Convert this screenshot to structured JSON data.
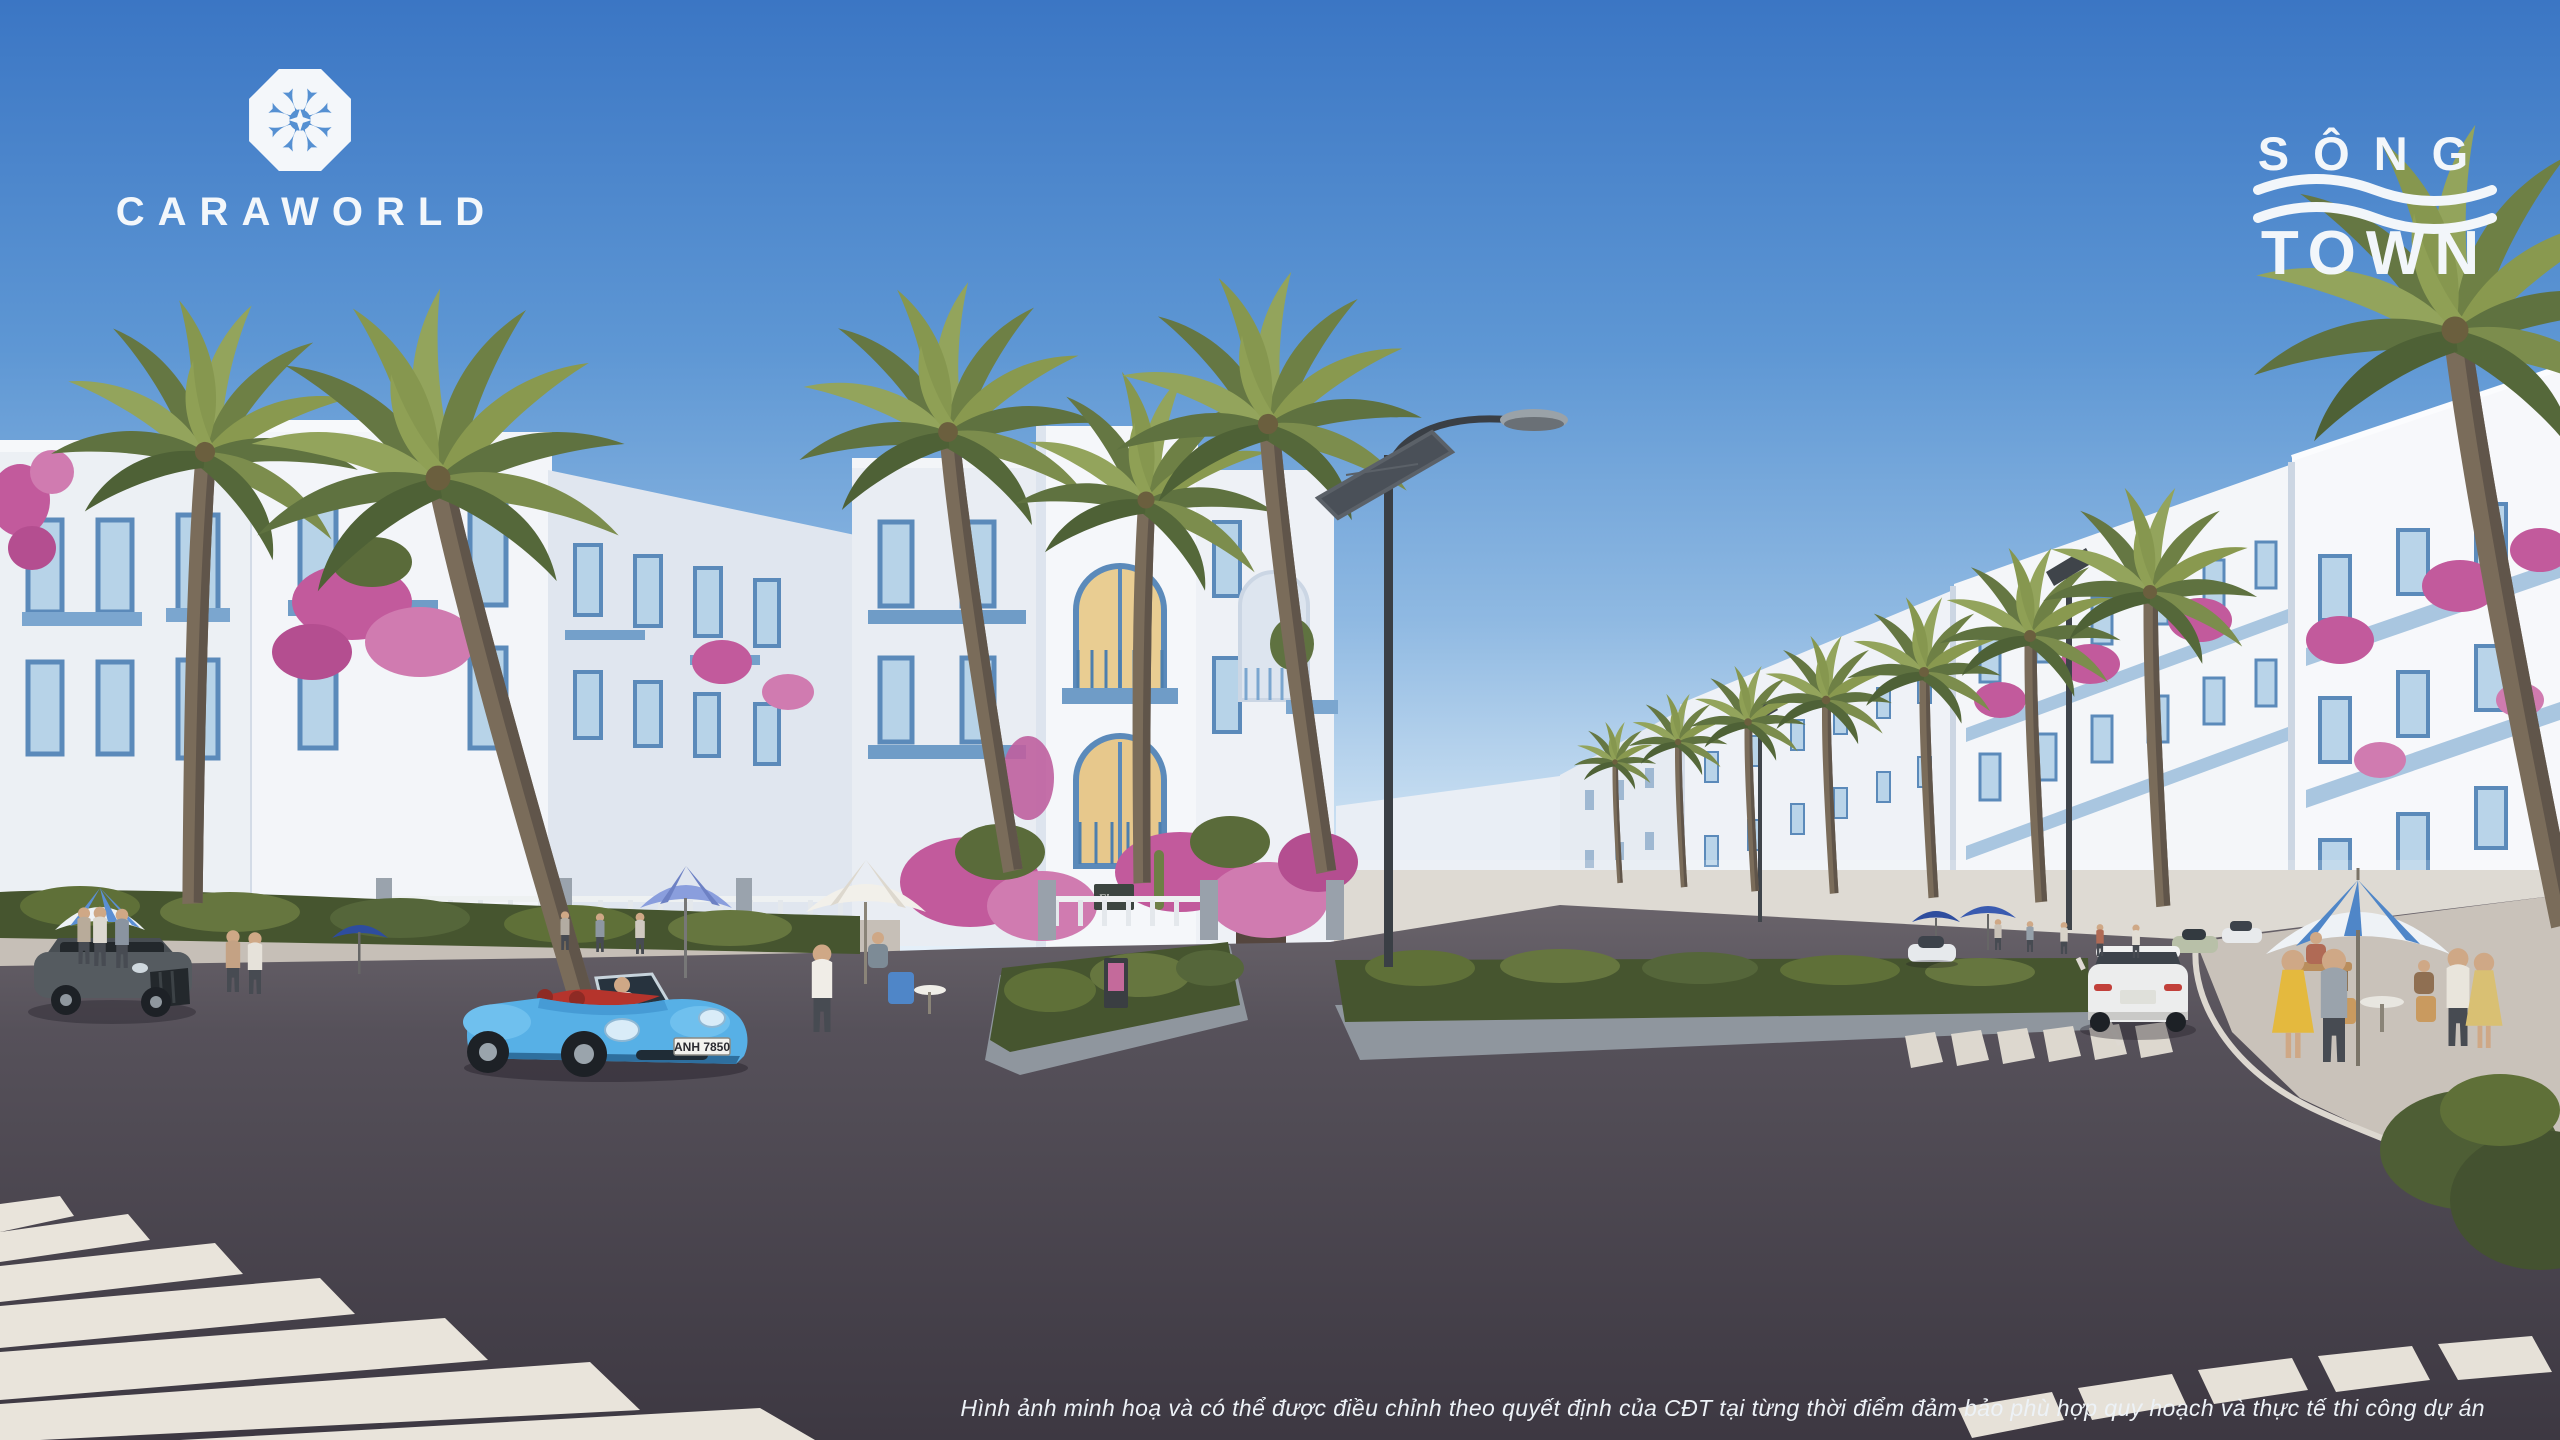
{
  "canvas": {
    "width": 2560,
    "height": 1440
  },
  "branding": {
    "caraworld": {
      "wordmark": "CARAWORLD",
      "icon": "caraworld-rosette-icon"
    },
    "songtown": {
      "line1": "SÔNG",
      "line2": "TOWN",
      "icon": "wave-icon"
    }
  },
  "street_scene": {
    "porsche_license_plate": "ANH 7850",
    "shop_sign": "Fleurs"
  },
  "disclaimer": "Hình ảnh minh hoạ và có thể được điều chỉnh theo quyết định của CĐT tại từng thời điểm đảm bảo phù hợp quy hoạch và thực tế thi công dự án",
  "colors": {
    "sky_top": "#3b76c4",
    "sky_horizon": "#e9f2fa",
    "building_white": "#f5f6f9",
    "accent_blue": "#5b8aba",
    "balcony_blue": "#a9c6e0",
    "bougainvillea_pink": "#c25a9c",
    "palm_green": "#7c8d4d",
    "asphalt": "#46414a",
    "sidewalk": "#c9c2ba",
    "porsche_blue": "#59b1e6",
    "umbrella_navy": "#2e4d9e",
    "dress_yellow": "#e4b93e"
  }
}
